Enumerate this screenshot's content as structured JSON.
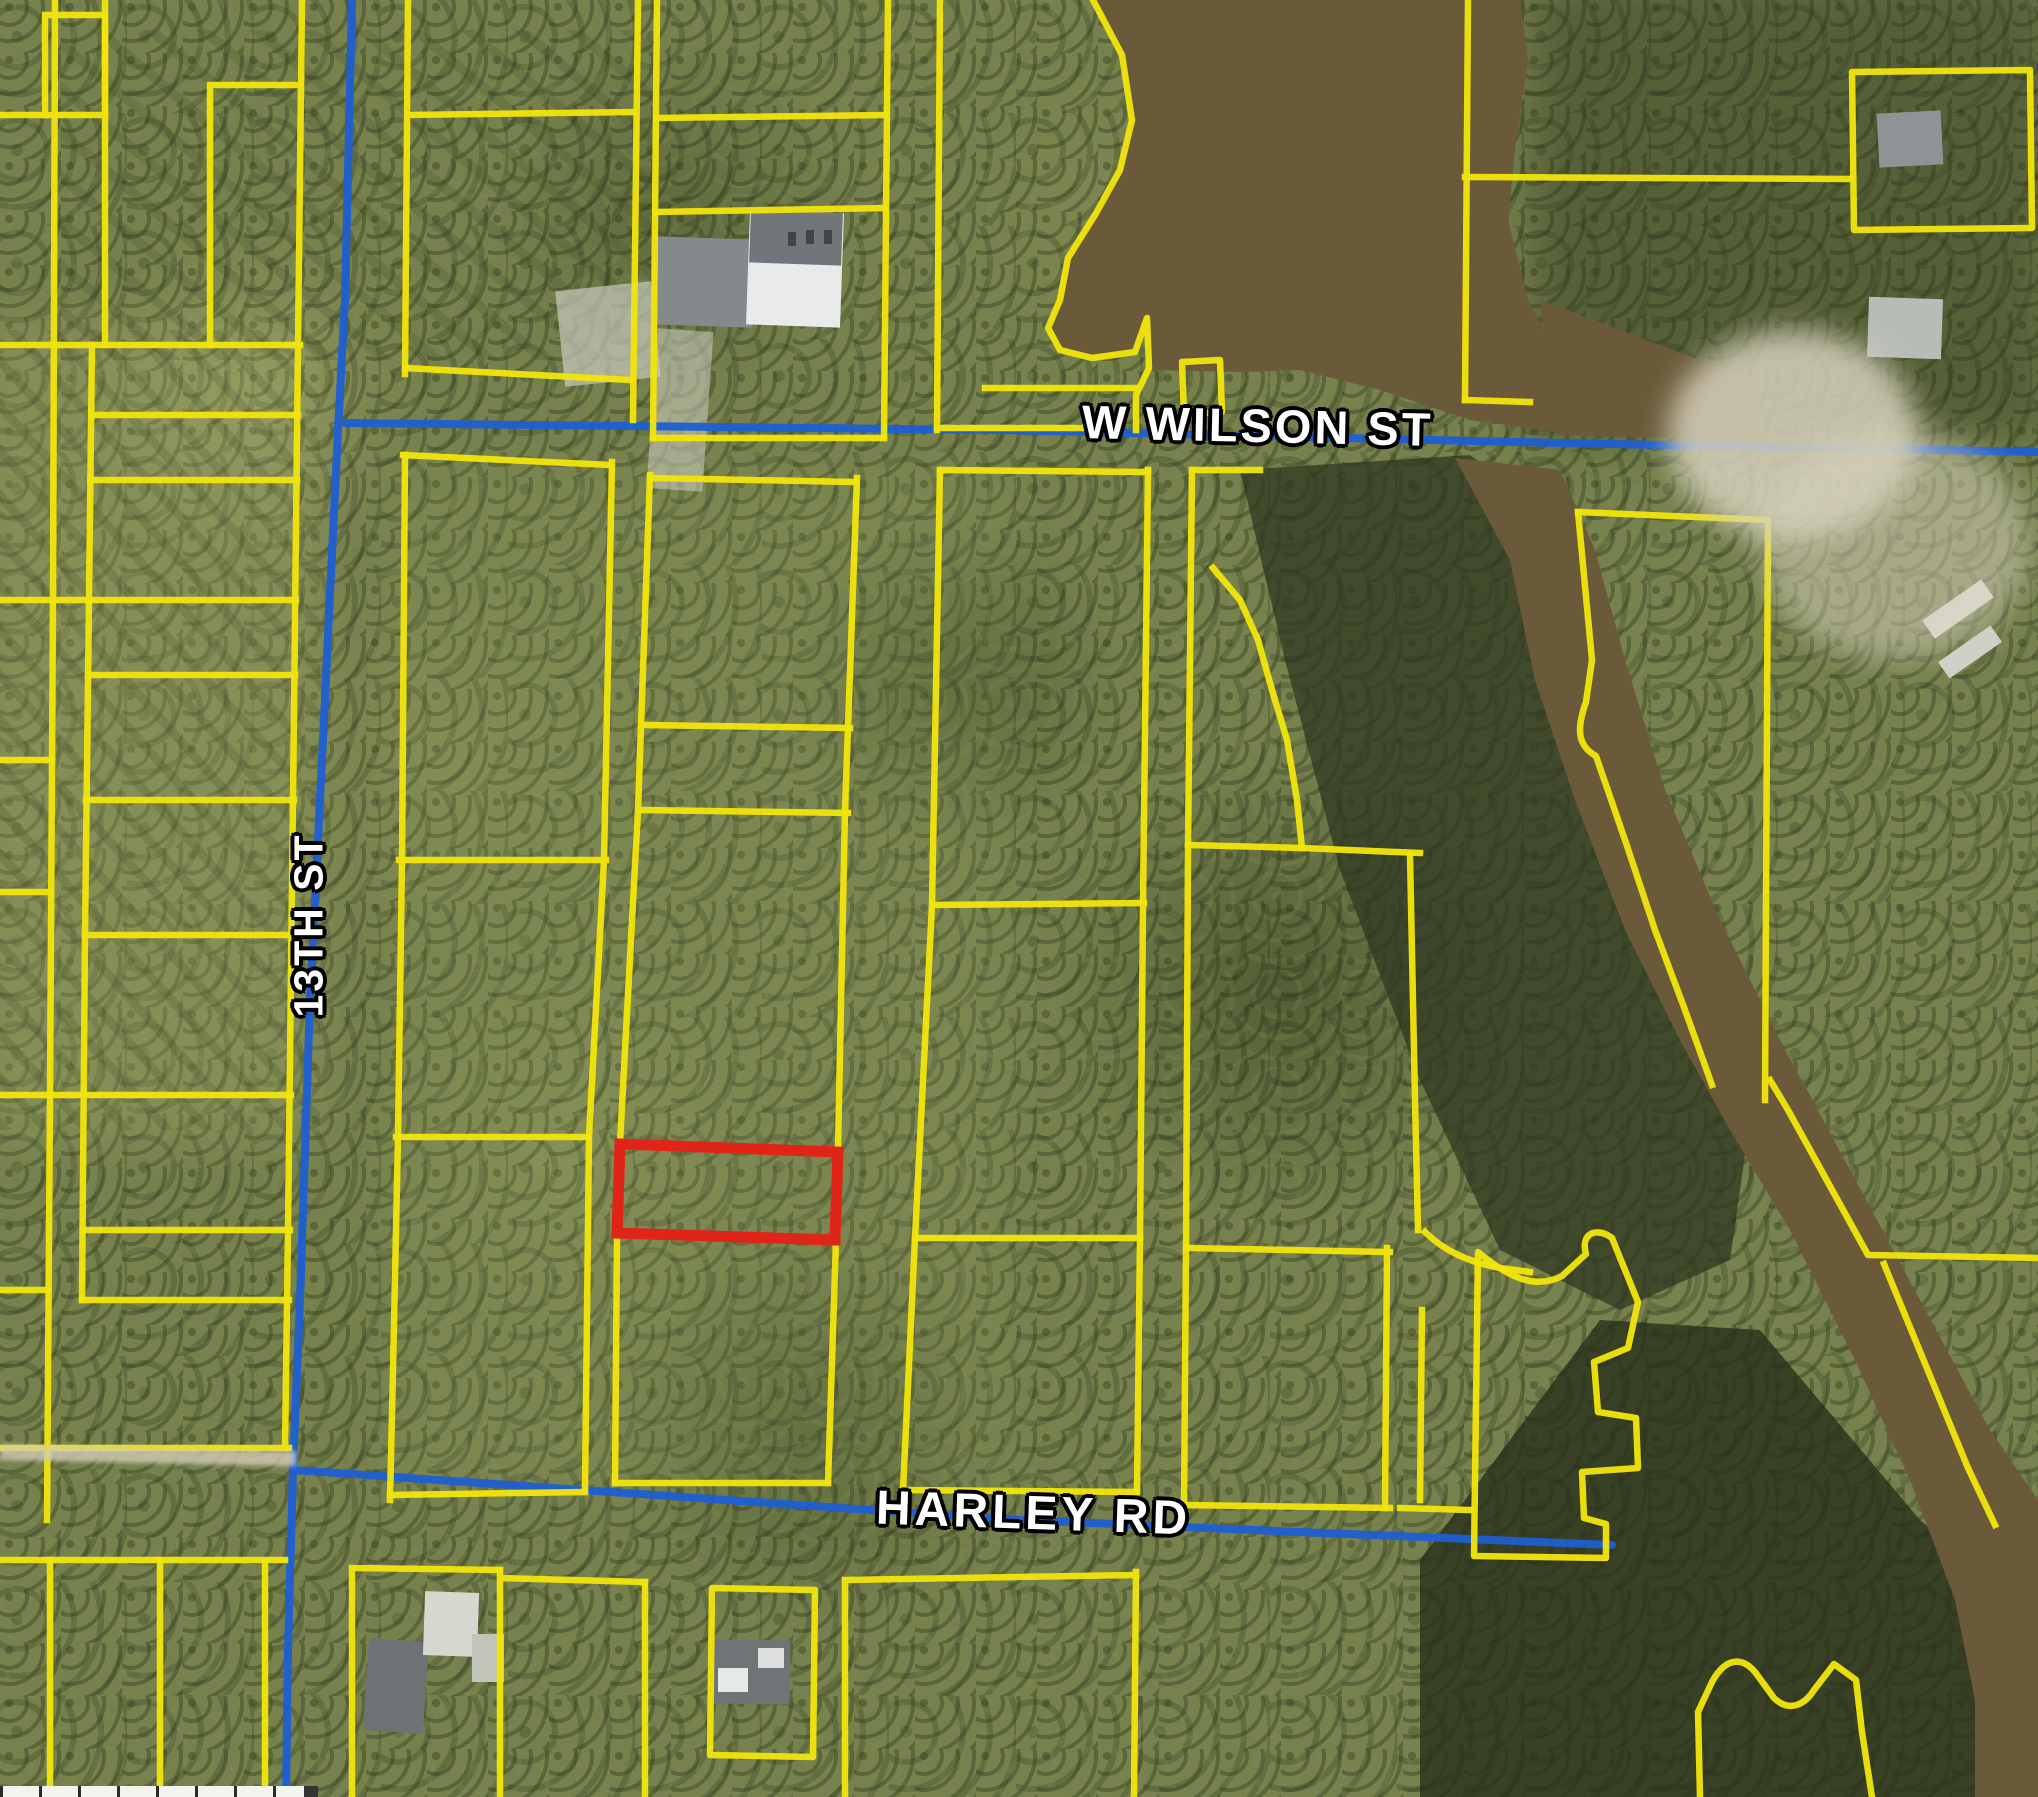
{
  "map": {
    "type": "aerial-parcel-map",
    "road_labels": [
      {
        "id": "w-wilson-st",
        "text": "W WILSON ST",
        "orientation": "horizontal"
      },
      {
        "id": "thirteenth-st",
        "text": "13TH ST",
        "orientation": "vertical"
      },
      {
        "id": "harley-rd",
        "text": "HARLEY RD",
        "orientation": "horizontal"
      }
    ],
    "highlight_parcel": {
      "label": "subject-parcel",
      "color": "#e02418"
    },
    "colors": {
      "parcel_line": "#f0e40c",
      "road_line": "#1e5fd2",
      "label_text": "#ffffff",
      "label_halo": "#000000",
      "water": "#6b5a39",
      "canopy": "#76814d",
      "sand": "#d6d1bc"
    }
  }
}
